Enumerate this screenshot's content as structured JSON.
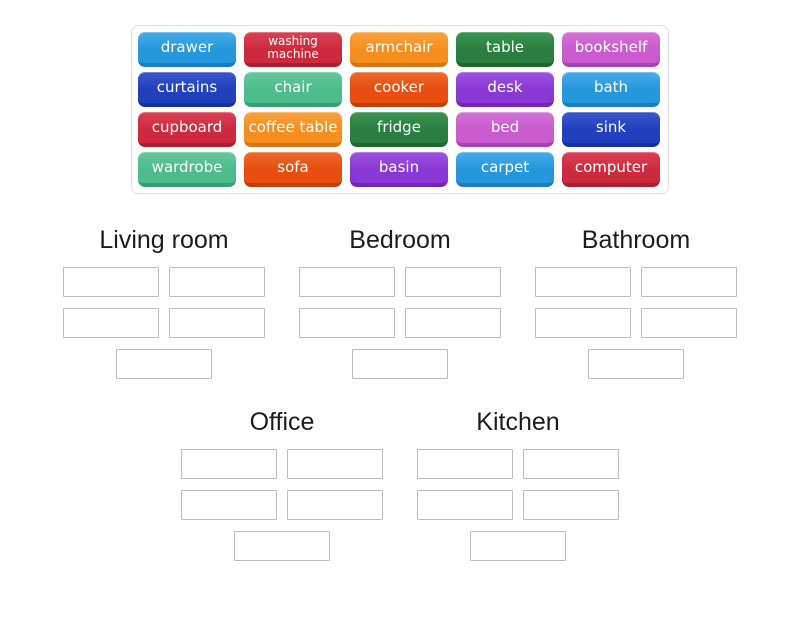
{
  "word_bank": {
    "tiles": [
      {
        "label": "drawer",
        "color": "lightblue"
      },
      {
        "label": "washing machine",
        "color": "red",
        "small": true
      },
      {
        "label": "armchair",
        "color": "orange"
      },
      {
        "label": "table",
        "color": "green"
      },
      {
        "label": "bookshelf",
        "color": "orchid"
      },
      {
        "label": "curtains",
        "color": "darkblue"
      },
      {
        "label": "chair",
        "color": "seagreen"
      },
      {
        "label": "cooker",
        "color": "orangered"
      },
      {
        "label": "desk",
        "color": "purple"
      },
      {
        "label": "bath",
        "color": "lightblue"
      },
      {
        "label": "cupboard",
        "color": "red"
      },
      {
        "label": "coffee table",
        "color": "orange"
      },
      {
        "label": "fridge",
        "color": "green"
      },
      {
        "label": "bed",
        "color": "orchid"
      },
      {
        "label": "sink",
        "color": "darkblue"
      },
      {
        "label": "wardrobe",
        "color": "seagreen"
      },
      {
        "label": "sofa",
        "color": "orangered"
      },
      {
        "label": "basin",
        "color": "purple"
      },
      {
        "label": "carpet",
        "color": "lightblue"
      },
      {
        "label": "computer",
        "color": "red"
      }
    ]
  },
  "palette": {
    "lightblue": {
      "light": "#47ACE8",
      "base": "#2598DD",
      "dark": "#1B7EBD"
    },
    "red": {
      "light": "#DA4156",
      "base": "#CE2A3E",
      "dark": "#AC1F31"
    },
    "orange": {
      "light": "#F8A33E",
      "base": "#F68E1E",
      "dark": "#D4760F"
    },
    "green": {
      "light": "#3A9552",
      "base": "#2A7F40",
      "dark": "#1F6631"
    },
    "orchid": {
      "light": "#D573D9",
      "base": "#C95BCE",
      "dark": "#A944AE"
    },
    "darkblue": {
      "light": "#3A58CC",
      "base": "#2140BE",
      "dark": "#17309E"
    },
    "seagreen": {
      "light": "#66C89E",
      "base": "#4CBC8B",
      "dark": "#379F73"
    },
    "orangered": {
      "light": "#EE6A2E",
      "base": "#E74E0F",
      "dark": "#C23F07"
    },
    "purple": {
      "light": "#9C55DE",
      "base": "#8938D6",
      "dark": "#7026B6"
    }
  },
  "groups": [
    {
      "label": "Living room",
      "slot_count": 5,
      "row": "top"
    },
    {
      "label": "Bedroom",
      "slot_count": 5,
      "row": "top"
    },
    {
      "label": "Bathroom",
      "slot_count": 5,
      "row": "top"
    },
    {
      "label": "Office",
      "slot_count": 5,
      "row": "bottom"
    },
    {
      "label": "Kitchen",
      "slot_count": 5,
      "row": "bottom"
    }
  ],
  "slot_rows_layout": [
    2,
    2,
    1
  ]
}
